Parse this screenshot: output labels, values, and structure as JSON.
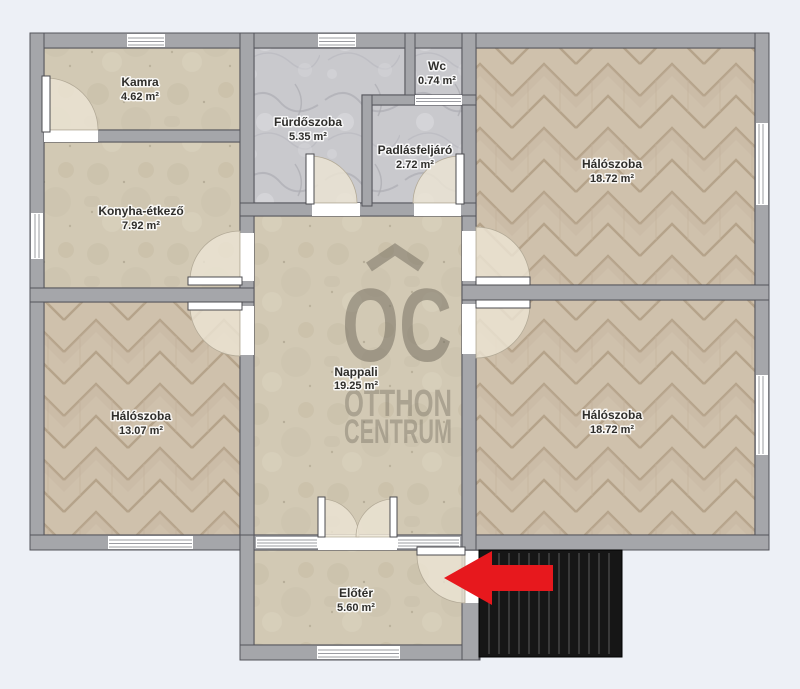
{
  "watermark": {
    "logo": "OC",
    "line1": "OTTHON",
    "line2": "CENTRUM"
  },
  "rooms": [
    {
      "id": "kamra",
      "name": "Kamra",
      "area": "4.62 m²",
      "floor": "stone"
    },
    {
      "id": "furdoszoba",
      "name": "Fürdőszoba",
      "area": "5.35 m²",
      "floor": "marble"
    },
    {
      "id": "wc",
      "name": "Wc",
      "area": "0.74 m²",
      "floor": "marble"
    },
    {
      "id": "padlasfeljaro",
      "name": "Padlásfeljáró",
      "area": "2.72 m²",
      "floor": "marble"
    },
    {
      "id": "haloszoba-top-right",
      "name": "Hálószoba",
      "area": "18.72 m²",
      "floor": "parquet"
    },
    {
      "id": "konyha-etkezo",
      "name": "Konyha-étkező",
      "area": "7.92 m²",
      "floor": "stone"
    },
    {
      "id": "nappali",
      "name": "Nappali",
      "area": "19.25 m²",
      "floor": "stone"
    },
    {
      "id": "haloszoba-bottom-left",
      "name": "Hálószoba",
      "area": "13.07 m²",
      "floor": "parquet"
    },
    {
      "id": "haloszoba-bottom-right",
      "name": "Hálószoba",
      "area": "18.72 m²",
      "floor": "parquet"
    },
    {
      "id": "eloter",
      "name": "Előtér",
      "area": "5.60 m²",
      "floor": "stone"
    }
  ],
  "palette": {
    "background": "#edf0f6",
    "wall_gray": "#a5a6aa",
    "arrow_red": "#e7181d",
    "stairs_black": "#161616",
    "watermark": "#6f695c"
  }
}
